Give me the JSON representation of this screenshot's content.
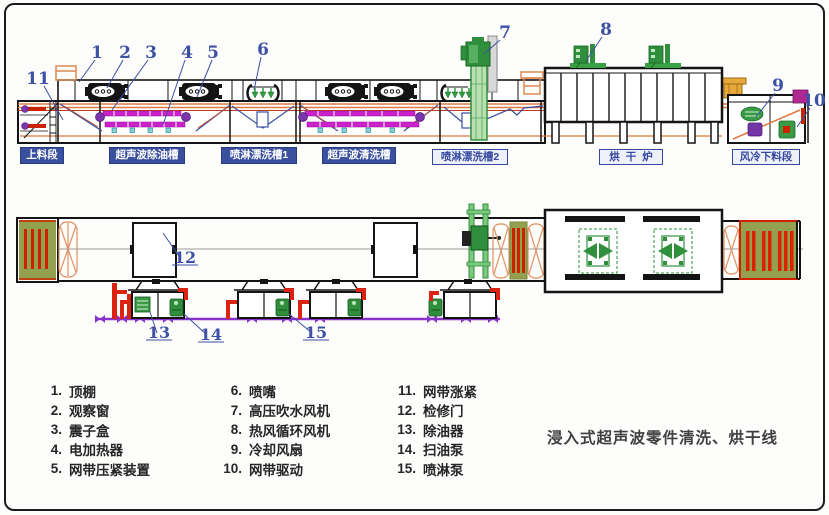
{
  "title": "浸入式超声波零件清洗、烘干线",
  "side": {
    "labels": [
      {
        "text": "上料段"
      },
      {
        "text": "超声波除油槽"
      },
      {
        "text": "喷淋漂洗槽1"
      },
      {
        "text": "超声波清洗槽"
      },
      {
        "text": "喷淋漂洗槽2"
      },
      {
        "text": "烘干炉"
      },
      {
        "text": "风冷下料段"
      }
    ],
    "callouts": [
      "1",
      "2",
      "3",
      "4",
      "5",
      "6",
      "7",
      "8",
      "9",
      "10",
      "11"
    ]
  },
  "plan": {
    "callouts": [
      "12",
      "13",
      "14",
      "15"
    ]
  },
  "legend": {
    "col1": [
      {
        "n": "1.",
        "t": "顶棚"
      },
      {
        "n": "2.",
        "t": "观察窗"
      },
      {
        "n": "3.",
        "t": "震子盒"
      },
      {
        "n": "4.",
        "t": "电加热器"
      },
      {
        "n": "5.",
        "t": "网带压紧装置"
      }
    ],
    "col2": [
      {
        "n": "6.",
        "t": "喷嘴"
      },
      {
        "n": "7.",
        "t": "高压吹水风机"
      },
      {
        "n": "8.",
        "t": "热风循环风机"
      },
      {
        "n": "9.",
        "t": "冷却风扇"
      },
      {
        "n": "10.",
        "t": "网带驱动"
      }
    ],
    "col3": [
      {
        "n": "11.",
        "t": "网带涨紧"
      },
      {
        "n": "12.",
        "t": "检修门"
      },
      {
        "n": "13.",
        "t": "除油器"
      },
      {
        "n": "14.",
        "t": "扫油泵"
      },
      {
        "n": "15.",
        "t": "喷淋泵"
      }
    ]
  },
  "colors": {
    "callout_blue": "#3c50a5",
    "label_blue": "#3a4f9e",
    "machine_black": "#141414",
    "belt_orange": "#e07840",
    "heater_magenta": "#cc22cc",
    "pump_green": "#2f8f3c",
    "pipe_purple": "#8833cc",
    "pipe_red": "#dd2211",
    "panel_olive": "#93a050"
  }
}
